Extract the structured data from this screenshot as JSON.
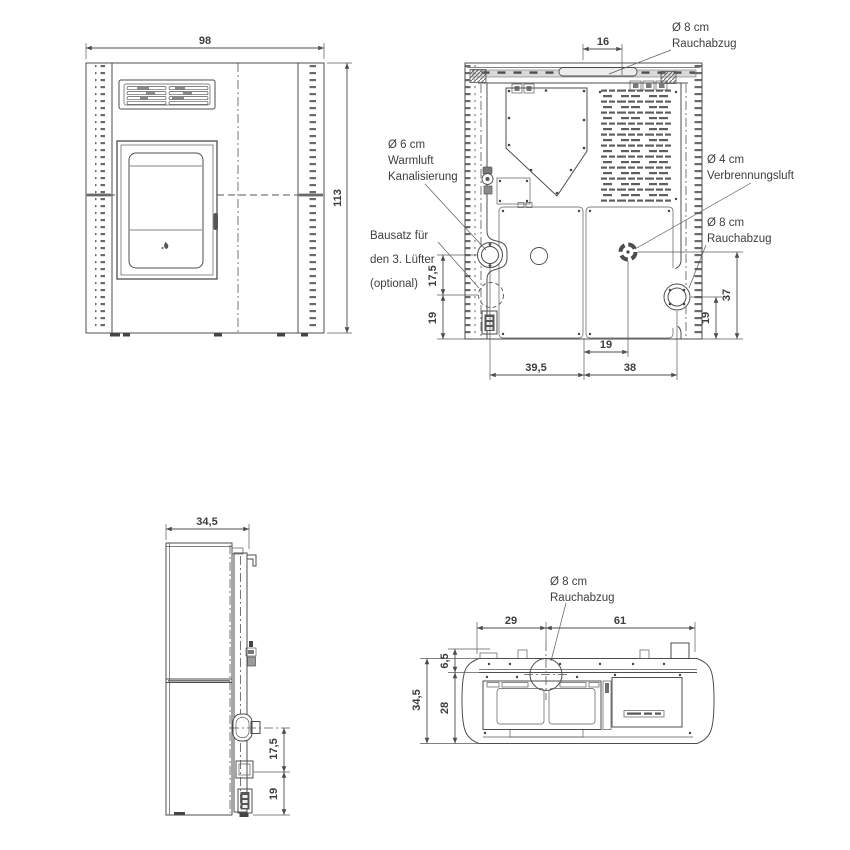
{
  "views": {
    "front": {
      "width_cm": "98",
      "height_cm": "113"
    },
    "rear": {
      "top_offset": "16",
      "smoke_top_line1": "Ø 8 cm",
      "smoke_top_line2": "Rauchabzug",
      "warmair_line1": "Ø 6 cm",
      "warmair_line2": "Warmluft",
      "warmair_line3": "Kanalisierung",
      "fankit_line1": "Bausatz für",
      "fankit_line2": "den 3. Lüfter",
      "fankit_line3": "(optional)",
      "comb_line1": "Ø 4 cm",
      "comb_line2": "Verbrennungsluft",
      "smoke_rear_line1": "Ø 8 cm",
      "smoke_rear_line2": "Rauchabzug",
      "left_upper": "17,5",
      "left_lower": "19",
      "right_upper": "37",
      "right_lower": "19",
      "bottom_center": "19",
      "bottom_left": "39,5",
      "bottom_right": "38"
    },
    "side": {
      "depth_cm": "34,5",
      "outlet_offset": "17,5",
      "inlet_offset": "19"
    },
    "top": {
      "smoke_line1": "Ø 8 cm",
      "smoke_line2": "Rauchabzug",
      "back_left": "29",
      "back_right": "61",
      "rim": "6,5",
      "body_depth": "28",
      "depth_cm": "34,5"
    }
  },
  "colors": {
    "line": "#4d4d4d",
    "text": "#3e3e3e",
    "panel_bar": "#d9d9d9",
    "slot": "#5f5f5f"
  }
}
